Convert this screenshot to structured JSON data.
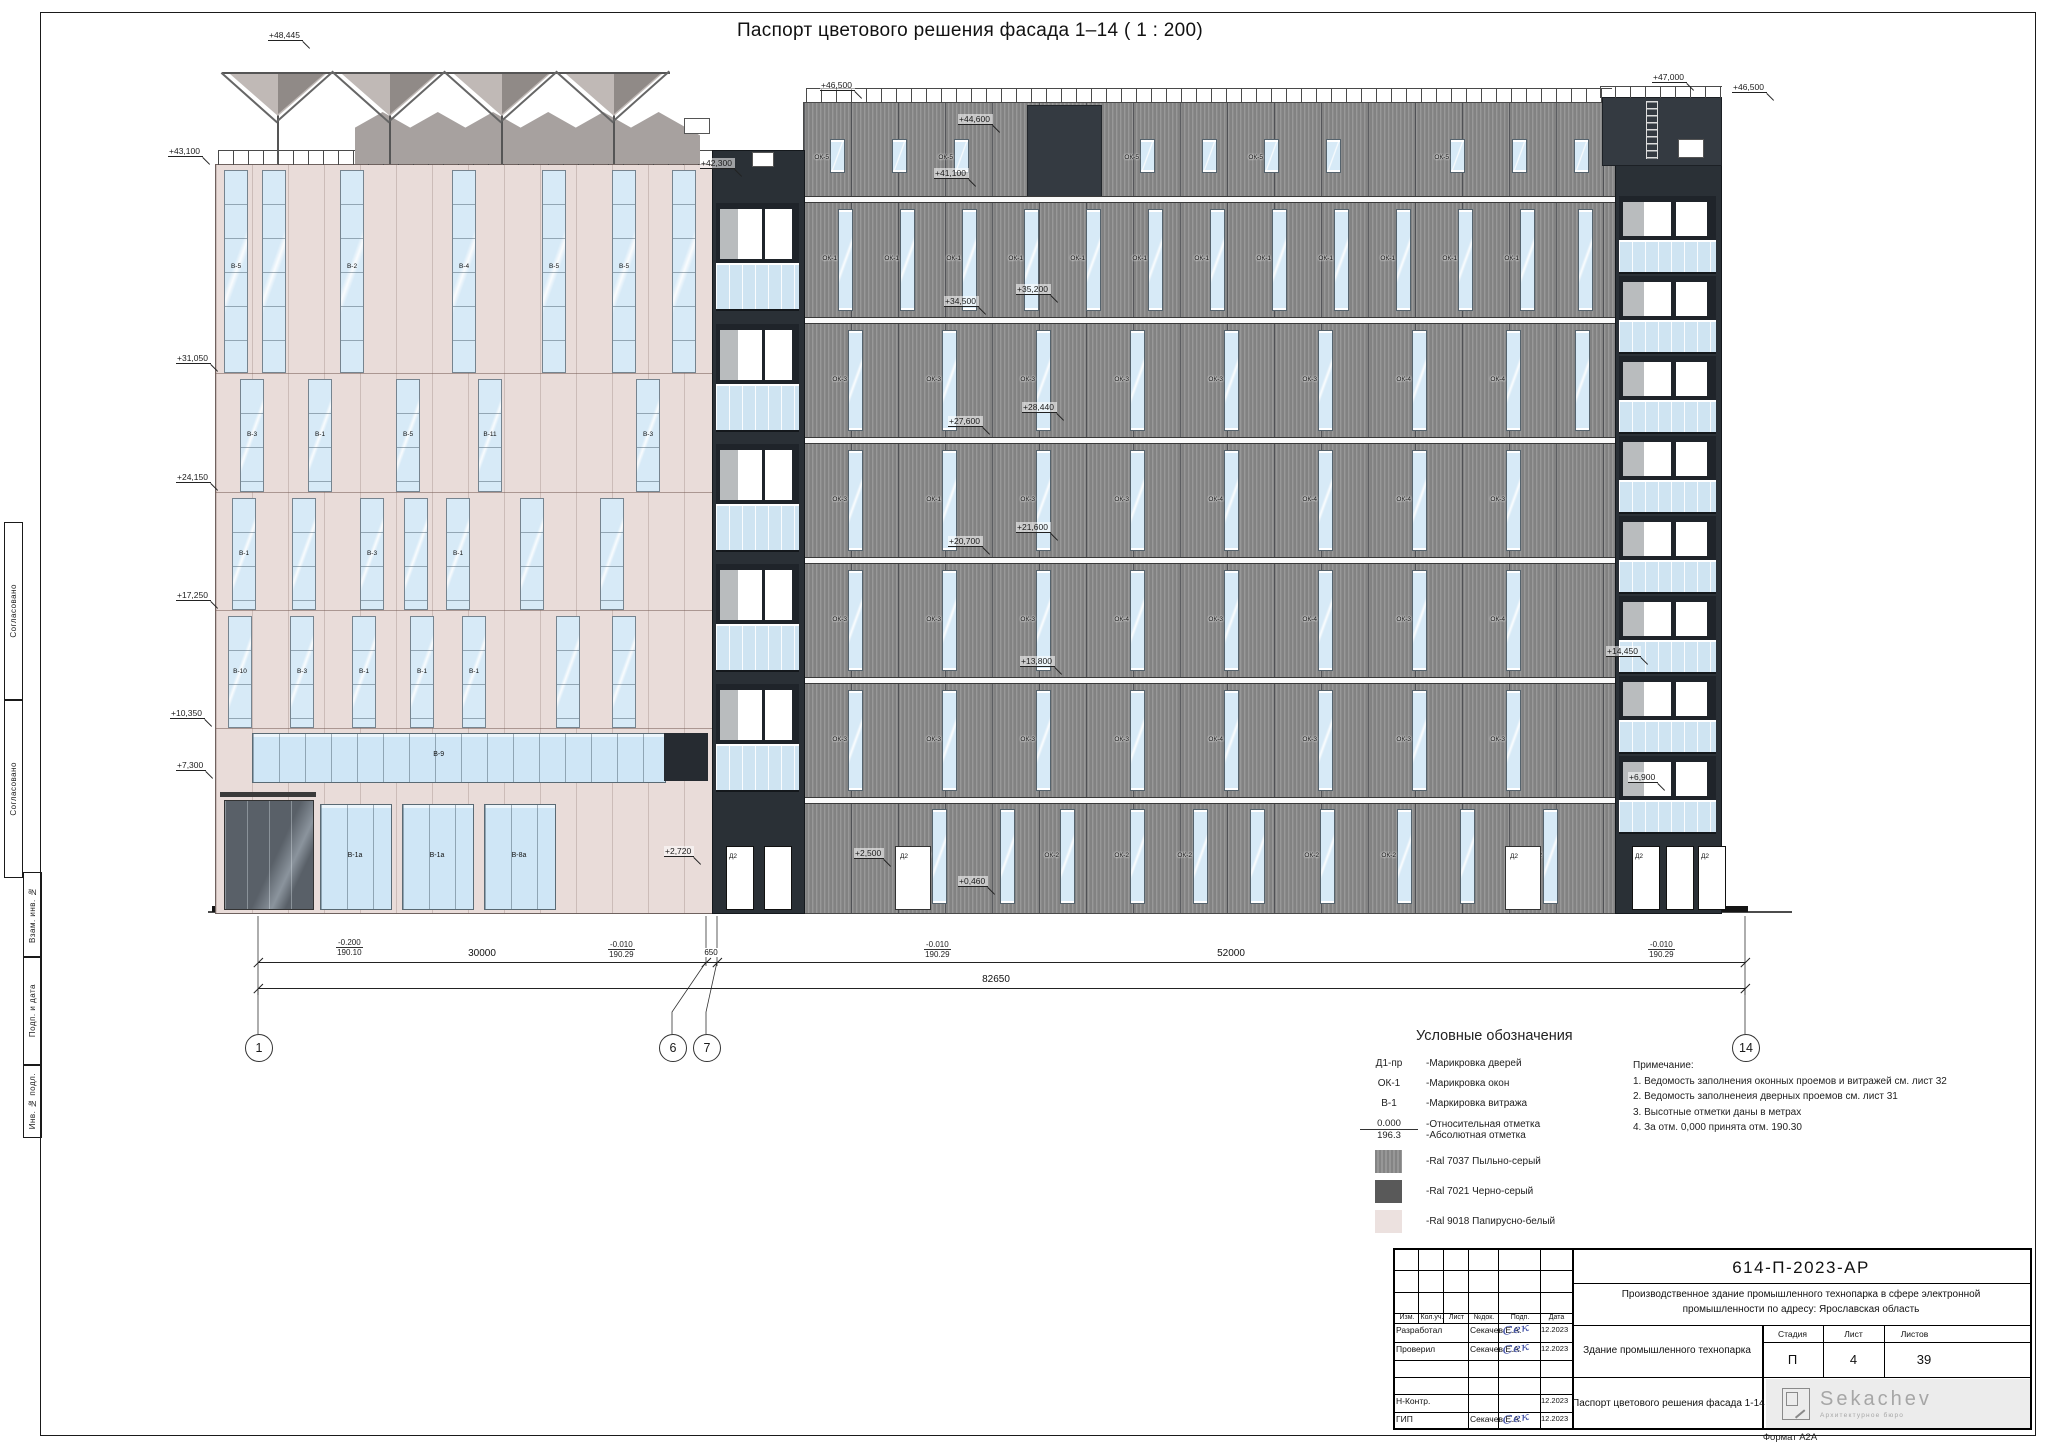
{
  "title": "Паспорт цветового решения фасада 1–14 ( 1 : 200)",
  "sheet": {
    "format": "Формат А2А"
  },
  "side_stamp": {
    "items": [
      "Согласовано",
      "Согласовано",
      "Взам. инв. №",
      "Подп. и дата",
      "Инв. № подл."
    ]
  },
  "colors": {
    "ral7037": "#8f8f8f",
    "ral7021": "#595959",
    "ral9018": "#ece1df",
    "glass": "#d7eaf7",
    "dark_strip": "#2a3036",
    "pink": "#e9dcd9"
  },
  "drawing": {
    "ground_y": 912,
    "pink": {
      "x": 215,
      "w": 497,
      "top": 164,
      "floor_lines": [
        373,
        492,
        610,
        728
      ],
      "bands": [
        {
          "y1": 170,
          "y2": 371,
          "strips": [
            {
              "x": 224,
              "l": "В-5"
            },
            {
              "x": 262,
              "l": ""
            },
            {
              "x": 340,
              "l": "В-2"
            },
            {
              "x": 452,
              "l": "В-4"
            },
            {
              "x": 542,
              "l": "В-5"
            },
            {
              "x": 612,
              "l": "В-5"
            },
            {
              "x": 672,
              "l": ""
            }
          ]
        },
        {
          "y1": 379,
          "y2": 490,
          "strips": [
            {
              "x": 240,
              "l": "В-3"
            },
            {
              "x": 308,
              "l": "В-1"
            },
            {
              "x": 396,
              "l": "В-5"
            },
            {
              "x": 478,
              "l": "В-11"
            },
            {
              "x": 636,
              "l": "В-3"
            }
          ]
        },
        {
          "y1": 498,
          "y2": 608,
          "strips": [
            {
              "x": 232,
              "l": "В-1"
            },
            {
              "x": 292,
              "l": ""
            },
            {
              "x": 360,
              "l": "В-3"
            },
            {
              "x": 404,
              "l": ""
            },
            {
              "x": 446,
              "l": "В-1"
            },
            {
              "x": 520,
              "l": ""
            },
            {
              "x": 600,
              "l": ""
            }
          ]
        },
        {
          "y1": 616,
          "y2": 726,
          "strips": [
            {
              "x": 228,
              "l": "В-10"
            },
            {
              "x": 290,
              "l": "В-3"
            },
            {
              "x": 352,
              "l": "В-1"
            },
            {
              "x": 410,
              "l": "В-1"
            },
            {
              "x": 462,
              "l": "В-1"
            },
            {
              "x": 556,
              "l": ""
            },
            {
              "x": 612,
              "l": ""
            }
          ]
        }
      ],
      "ribbon": {
        "x1": 252,
        "x2": 664,
        "y1": 733,
        "y2": 781,
        "l": "В-9",
        "dark_w": 44
      },
      "storefronts": [
        {
          "x": 320,
          "w": 70,
          "l": "В-1а"
        },
        {
          "x": 402,
          "w": 70,
          "l": "В-1а"
        },
        {
          "x": 484,
          "w": 70,
          "l": "В-8а"
        }
      ],
      "entrance": {
        "x": 224,
        "w": 88
      }
    },
    "gray": {
      "x": 803,
      "w": 812,
      "top": 102,
      "bands_y": [
        196,
        317,
        437,
        557,
        677,
        797
      ],
      "parapet": {
        "y": 139,
        "h": 32,
        "win_xs": [
          830,
          892,
          954,
          1140,
          1202,
          1264,
          1326,
          1450,
          1512,
          1574
        ],
        "labels": [
          "ОК-5",
          "",
          "ОК-5",
          "ОК-5",
          "",
          "ОК-5",
          "",
          "ОК-5",
          "",
          ""
        ]
      },
      "slab": {
        "x": 1027,
        "w": 73
      },
      "floors": [
        {
          "y1": 203,
          "y2": 317,
          "ws": [
            [
              838,
              "ОК-1"
            ],
            [
              900,
              "ОК-1"
            ],
            [
              962,
              "ОК-1"
            ],
            [
              1024,
              "ОК-1"
            ],
            [
              1086,
              "ОК-1"
            ],
            [
              1148,
              "ОК-1"
            ],
            [
              1210,
              "ОК-1"
            ],
            [
              1272,
              "ОК-1"
            ],
            [
              1334,
              "ОК-1"
            ],
            [
              1396,
              "ОК-1"
            ],
            [
              1458,
              "ОК-1"
            ],
            [
              1520,
              "ОК-1"
            ],
            [
              1578,
              ""
            ]
          ]
        },
        {
          "y1": 324,
          "y2": 437,
          "ws": [
            [
              848,
              "ОК-3"
            ],
            [
              942,
              "ОК-3"
            ],
            [
              1036,
              "ОК-3"
            ],
            [
              1130,
              "ОК-3"
            ],
            [
              1224,
              "ОК-3"
            ],
            [
              1318,
              "ОК-3"
            ],
            [
              1412,
              "ОК-4"
            ],
            [
              1506,
              "ОК-4"
            ],
            [
              1575,
              ""
            ]
          ]
        },
        {
          "y1": 444,
          "y2": 557,
          "ws": [
            [
              848,
              "ОК-3"
            ],
            [
              942,
              "ОК-1"
            ],
            [
              1036,
              "ОК-3"
            ],
            [
              1130,
              "ОК-3"
            ],
            [
              1224,
              "ОК-4"
            ],
            [
              1318,
              "ОК-4"
            ],
            [
              1412,
              "ОК-4"
            ],
            [
              1506,
              "ОК-3"
            ]
          ]
        },
        {
          "y1": 564,
          "y2": 677,
          "ws": [
            [
              848,
              "ОК-3"
            ],
            [
              942,
              "ОК-3"
            ],
            [
              1036,
              "ОК-3"
            ],
            [
              1130,
              "ОК-4"
            ],
            [
              1224,
              "ОК-3"
            ],
            [
              1318,
              "ОК-4"
            ],
            [
              1412,
              "ОК-3"
            ],
            [
              1506,
              "ОК-4"
            ]
          ]
        },
        {
          "y1": 684,
          "y2": 797,
          "ws": [
            [
              848,
              "ОК-3"
            ],
            [
              942,
              "ОК-3"
            ],
            [
              1036,
              "ОК-3"
            ],
            [
              1130,
              "ОК-3"
            ],
            [
              1224,
              "ОК-4"
            ],
            [
              1318,
              "ОК-3"
            ],
            [
              1412,
              "ОК-3"
            ],
            [
              1506,
              "ОК-3"
            ]
          ]
        }
      ],
      "ground": {
        "y1": 797,
        "wins": [
          [
            932,
            "ОК-2"
          ],
          [
            1000,
            ""
          ],
          [
            1060,
            "ОК-2"
          ],
          [
            1130,
            "ОК-2"
          ],
          [
            1193,
            "ОК-2"
          ],
          [
            1250,
            ""
          ],
          [
            1320,
            "ОК-2"
          ],
          [
            1397,
            "ОК-2"
          ],
          [
            1460,
            ""
          ],
          [
            1543,
            "ОК-2"
          ]
        ],
        "doors": [
          [
            895,
            "Д2"
          ],
          [
            1505,
            "Д2"
          ]
        ]
      }
    },
    "balconies": [
      {
        "x": 712,
        "w": 91,
        "top": 150,
        "rows_y": [
          203,
          324,
          444,
          564,
          684
        ],
        "door_h": 50,
        "rail_h": 44,
        "ground_doors": [
          [
            726,
            "Д2"
          ],
          [
            764,
            ""
          ]
        ]
      },
      {
        "x": 1615,
        "w": 105,
        "top": 164,
        "rows_y": [
          196,
          276,
          356,
          436,
          516,
          596,
          676,
          756
        ],
        "door_h": 34,
        "rail_h": 30,
        "ground_doors": [
          [
            1632,
            "Д2"
          ],
          [
            1666,
            ""
          ],
          [
            1698,
            "Д2"
          ]
        ]
      }
    ],
    "tower": {
      "x": 1602,
      "w": 118,
      "y": 97
    },
    "marks": [
      [
        "+48,445",
        268,
        30
      ],
      [
        "+43,100",
        168,
        146
      ],
      [
        "+31,050",
        176,
        353
      ],
      [
        "+24,150",
        176,
        472
      ],
      [
        "+17,250",
        176,
        590
      ],
      [
        "+10,350",
        170,
        708
      ],
      [
        "+7,300",
        176,
        760
      ],
      [
        "+46,500",
        820,
        80
      ],
      [
        "+42,300",
        700,
        158
      ],
      [
        "+41,100",
        934,
        168
      ],
      [
        "+44,600",
        958,
        114
      ],
      [
        "+35,200",
        1016,
        284
      ],
      [
        "+34,500",
        944,
        296
      ],
      [
        "+28,440",
        1022,
        402
      ],
      [
        "+27,600",
        948,
        416
      ],
      [
        "+21,600",
        1016,
        522
      ],
      [
        "+20,700",
        948,
        536
      ],
      [
        "+13,800",
        1020,
        656
      ],
      [
        "+47,000",
        1652,
        72
      ],
      [
        "+46,500",
        1732,
        82
      ],
      [
        "+14,450",
        1606,
        646
      ],
      [
        "+6,900",
        1628,
        772
      ],
      [
        "+2,500",
        854,
        848
      ],
      [
        "+0,460",
        958,
        876
      ],
      [
        "+2,720",
        664,
        846
      ]
    ],
    "fractions": [
      {
        "t": "-0.200",
        "b": "190.10",
        "x": 336,
        "y": 938
      },
      {
        "t": "-0.010",
        "b": "190.29",
        "x": 608,
        "y": 940
      },
      {
        "t": "-0.010",
        "b": "190.29",
        "x": 924,
        "y": 940
      },
      {
        "t": "-0.010",
        "b": "190.29",
        "x": 1648,
        "y": 940
      }
    ],
    "dims": {
      "y1": 962,
      "y2": 988,
      "ticks1": [
        258,
        706,
        717,
        1745
      ],
      "ticks2": [
        258,
        1745
      ],
      "labels1": [
        [
          "30000",
          482
        ],
        [
          "650",
          711
        ],
        [
          "52000",
          1231
        ]
      ],
      "label2": [
        "82650",
        996
      ],
      "axes": [
        [
          "1",
          258
        ],
        [
          "6",
          672
        ],
        [
          "7",
          706
        ],
        [
          "14",
          1745
        ]
      ],
      "bub_y": 1047
    }
  },
  "legend": {
    "title": "Условные обозначения",
    "items": [
      {
        "k": "t",
        "a": "Д1-пр",
        "d": "-Марикровка дверей"
      },
      {
        "k": "t",
        "a": "ОК-1",
        "d": "-Марикровка окон"
      },
      {
        "k": "t",
        "a": "В-1",
        "d": "-Маркировка витража"
      },
      {
        "k": "lvl",
        "top": "0.000",
        "bot": "196.3",
        "d1": "-Относительная отметка",
        "d2": "-Абсолютная отметка"
      },
      {
        "k": "sw",
        "c": "#8f8f8f",
        "stripe": true,
        "d": "-Ral 7037 Пыльно-серый"
      },
      {
        "k": "sw",
        "c": "#595959",
        "stripe": false,
        "d": "-Ral 7021 Черно-серый"
      },
      {
        "k": "sw",
        "c": "#ece1df",
        "stripe": false,
        "d": "-Ral 9018 Папирусно-белый"
      }
    ]
  },
  "notes": {
    "lines": [
      "Примечание:",
      "1. Ведомость заполнения оконных проемов и витражей см. лист 32",
      "2. Ведомость заполненеия дверных проемов см. лист 31",
      "3. Высотные отметки даны в метрах",
      "4. За отм. 0,000 принята отм. 190.30"
    ]
  },
  "title_block": {
    "doc_number": "614-П-2023-АР",
    "description_1": "Производственное здание промышленного технопарка  в сфере электронной",
    "description_2": "промышленности по адресу: Ярославская область",
    "object_name": "Здание промышленного технопарка",
    "sheet_name": "Паспорт цветового решения фасада 1-14",
    "stage_headers": [
      "Стадия",
      "Лист",
      "Листов"
    ],
    "stage_values": [
      "П",
      "4",
      "39"
    ],
    "col_headers": [
      "Изм.",
      "Кол.уч.",
      "Лист",
      "№док.",
      "Подп.",
      "Дата"
    ],
    "rows": [
      {
        "role": "Разработал",
        "name": "Секачев Е.А.",
        "sig": true,
        "date": "12.2023"
      },
      {
        "role": "Проверил",
        "name": "Секачев Е.А.",
        "sig": true,
        "date": "12.2023"
      },
      {
        "role": "",
        "name": "",
        "sig": false,
        "date": ""
      },
      {
        "role": "",
        "name": "",
        "sig": false,
        "date": ""
      },
      {
        "role": "Н-Контр.",
        "name": "",
        "sig": false,
        "date": "12.2023"
      },
      {
        "role": "ГИП",
        "name": "Секачев Е.А.",
        "sig": true,
        "date": "12.2023"
      }
    ],
    "signature": "Сек",
    "logo": {
      "name": "Sekachev",
      "sub": "Архитектурное бюро"
    }
  }
}
